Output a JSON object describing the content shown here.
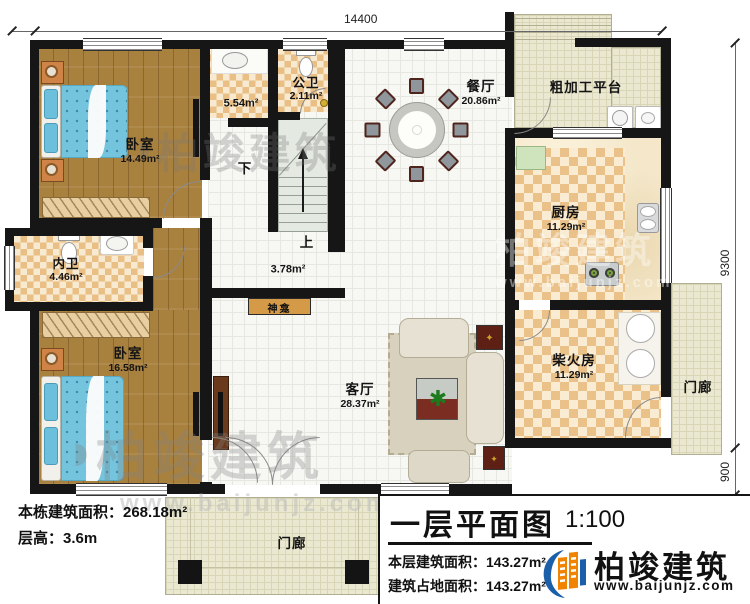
{
  "dims": {
    "top": "14400",
    "right_main": "9300",
    "right_porch": "900",
    "right_bottom": "2000"
  },
  "rooms": {
    "bedroom1": {
      "name": "卧室",
      "area": "14.49m²"
    },
    "bath_public": {
      "name": "公卫",
      "area": "2.11m²"
    },
    "wash_area": {
      "area": "5.54m²"
    },
    "dining": {
      "name": "餐厅",
      "area": "20.86m²"
    },
    "platform": {
      "name": "粗加工平台"
    },
    "kitchen": {
      "name": "厨房",
      "area": "11.29m²"
    },
    "bath_inner": {
      "name": "内卫",
      "area": "4.46m²"
    },
    "bedroom2": {
      "name": "卧室",
      "area": "16.58m²"
    },
    "shrine": {
      "name": "神龛"
    },
    "hall": {
      "area": "3.78m²"
    },
    "living": {
      "name": "客厅",
      "area": "28.37m²"
    },
    "firewood": {
      "name": "柴火房",
      "area": "11.29m²"
    },
    "porch_right": {
      "name": "门廊"
    },
    "porch_front": {
      "name": "门廊"
    },
    "stairs": {
      "up": "上",
      "down": "下"
    }
  },
  "notes": {
    "total_area": "本栋建筑面积：268.18m²",
    "floor_height": "层高：3.6m"
  },
  "title_block": {
    "title": "一层平面图",
    "scale": "1:100",
    "floor_area": "本层建筑面积：143.27m²",
    "footprint": "建筑占地面积：143.27m²"
  },
  "brand": {
    "name": "柏竣建筑",
    "site": "www.baijunjz.com"
  }
}
